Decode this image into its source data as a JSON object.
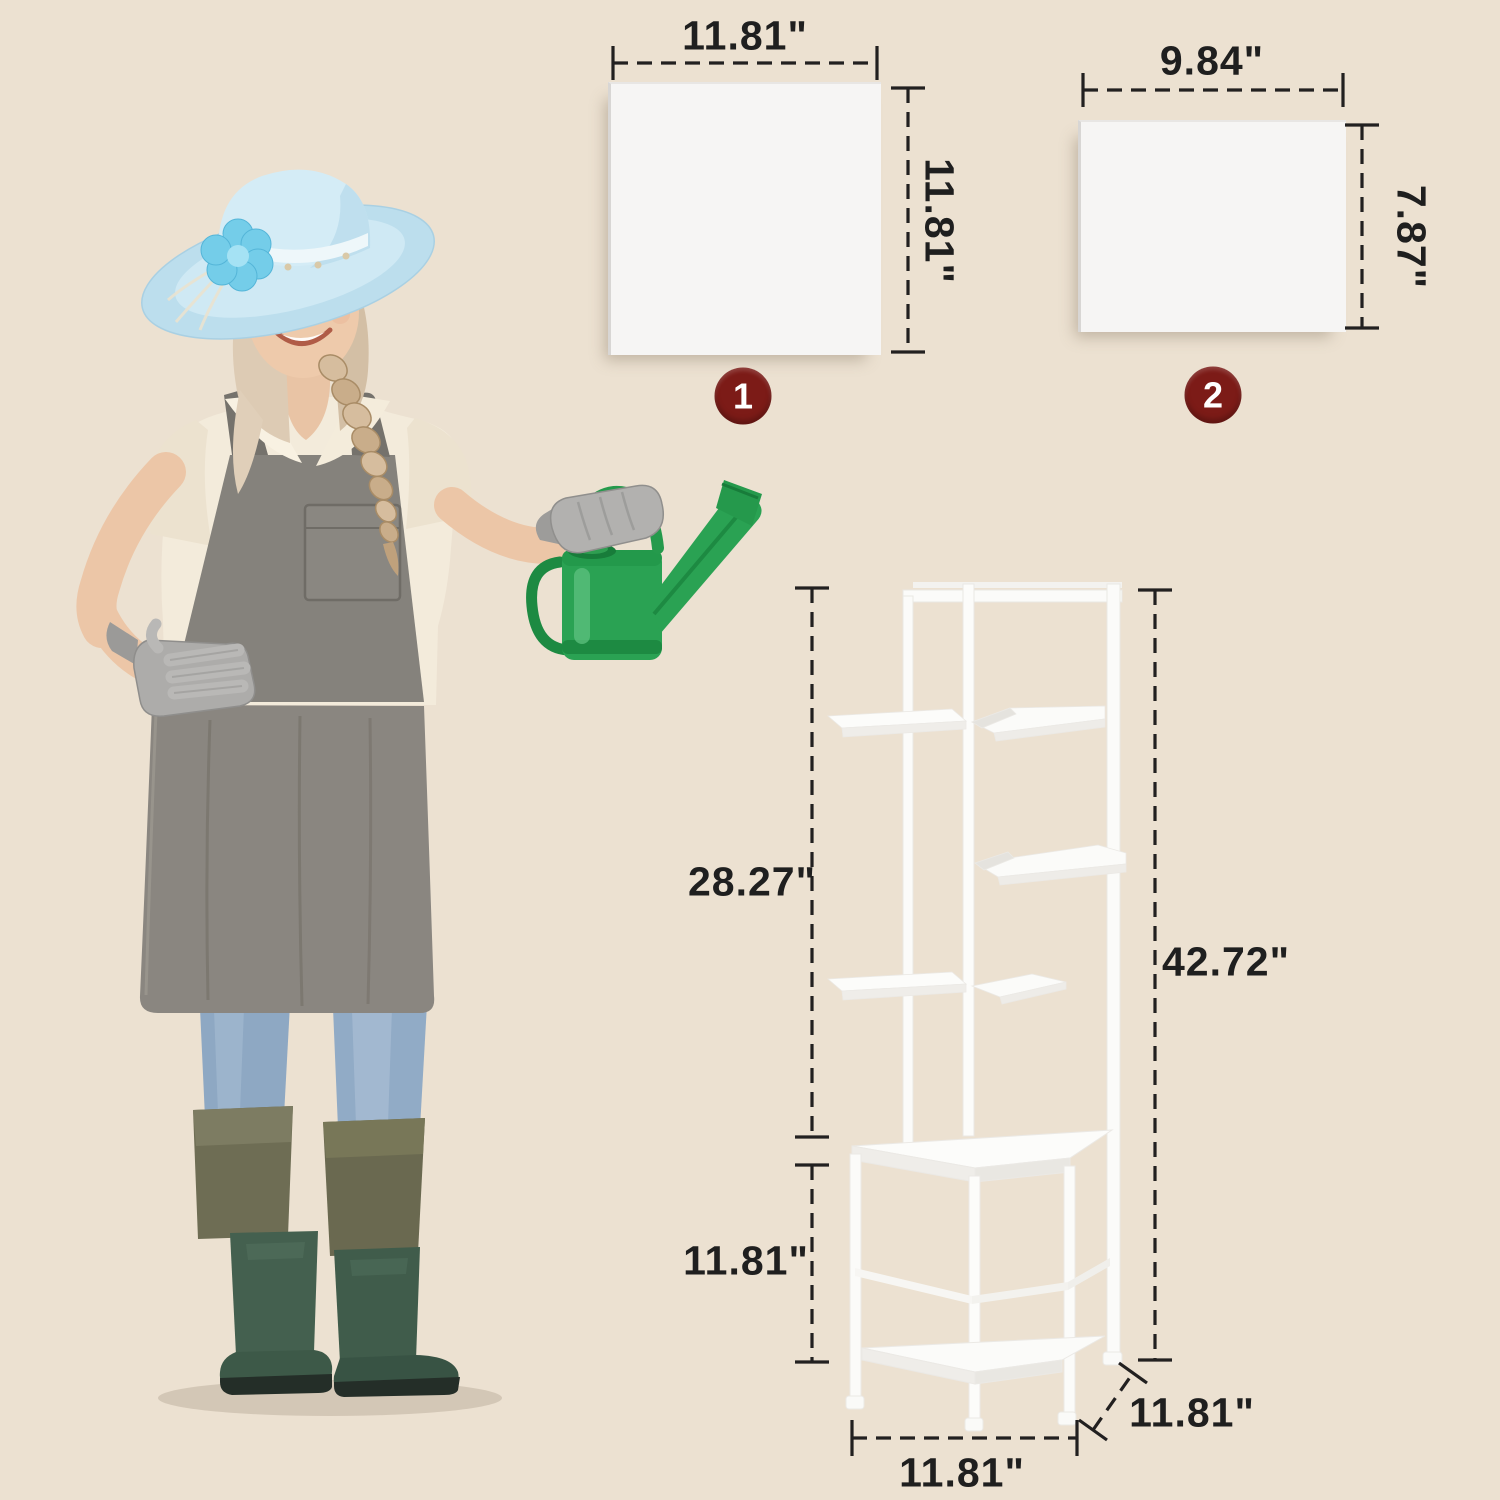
{
  "scene": {
    "background_color": "#ece1d1"
  },
  "panels": [
    {
      "badge": "1",
      "width_label": "11.81\"",
      "height_label": "11.81\""
    },
    {
      "badge": "2",
      "width_label": "9.84\"",
      "height_label": "7.87\""
    }
  ],
  "stand": {
    "upper_section_height_label": "28.27\"",
    "lower_section_height_label": "11.81\"",
    "total_height_label": "42.72\"",
    "base_width_label": "11.81\"",
    "base_depth_label": "11.81\""
  },
  "palette": {
    "badge_bg": "#7c1b17",
    "badge_text": "#ffffff",
    "dimension_text": "#1f1f1f",
    "dimension_line": "#222020",
    "panel_fill": "#f6f5f4",
    "stand_fill": "#fbfbf9",
    "watering_can_green": "#2aa253",
    "hat_blue": "#c9e5f1",
    "apron_gray": "#8a8680",
    "boots_green": "#44604f"
  }
}
